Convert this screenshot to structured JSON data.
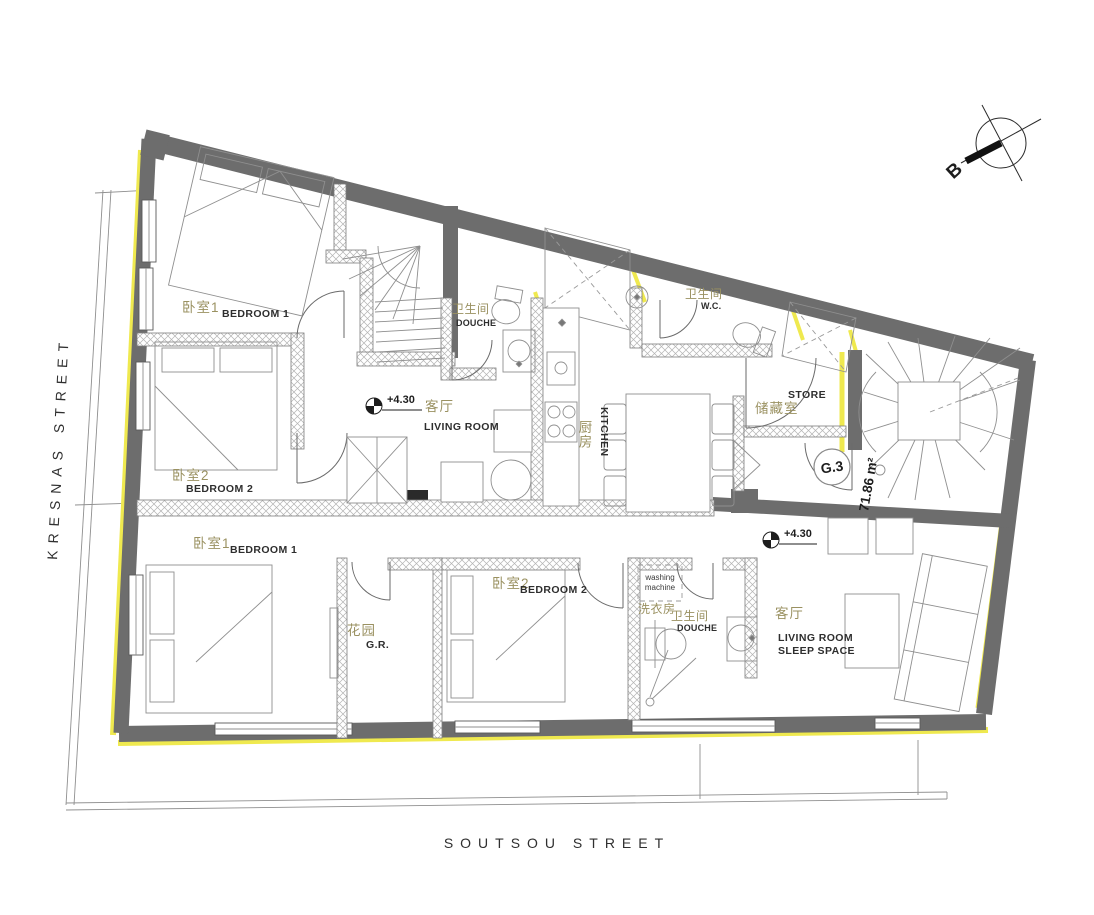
{
  "streets": {
    "left": "KRESNAS STREET",
    "bottom": "SOUTSOU STREET"
  },
  "compass": {
    "label": "B"
  },
  "unit": {
    "id": "G.3",
    "area": "71.86 m²"
  },
  "levels": {
    "upper": "+4.30",
    "lower": "+4.30"
  },
  "upper_apartment": {
    "bedroom1": {
      "zh": "卧室1",
      "en": "BEDROOM 1"
    },
    "bedroom2": {
      "zh": "卧室2",
      "en": "BEDROOM 2"
    },
    "douche": {
      "zh": "卫生间",
      "en": "DOUCHE"
    },
    "living": {
      "zh": "客厅",
      "en": "LIVING ROOM"
    },
    "kitchen": {
      "zh": "厨房",
      "en": "KITCHEN"
    },
    "wc": {
      "zh": "卫生间",
      "en": "W.C."
    },
    "store": {
      "zh": "储藏室",
      "en": "STORE"
    }
  },
  "lower_apartment": {
    "bedroom1": {
      "zh": "卧室1",
      "en": "BEDROOM 1"
    },
    "gr": {
      "zh": "花园",
      "en": "G.R."
    },
    "bedroom2": {
      "zh": "卧室2",
      "en": "BEDROOM 2"
    },
    "laundry": {
      "zh": "洗衣房",
      "en1": "washing",
      "en2": "machine"
    },
    "douche": {
      "zh": "卫生间",
      "en": "DOUCHE"
    },
    "living": {
      "zh": "客厅",
      "en1": "LIVING ROOM",
      "en2": "SLEEP SPACE"
    }
  },
  "colors": {
    "wall": "#6d6d6d",
    "insulation": "#efe94f",
    "hatchline": "#b3b3b3",
    "zh": "#9a9161",
    "en": "#2e2e2e"
  }
}
